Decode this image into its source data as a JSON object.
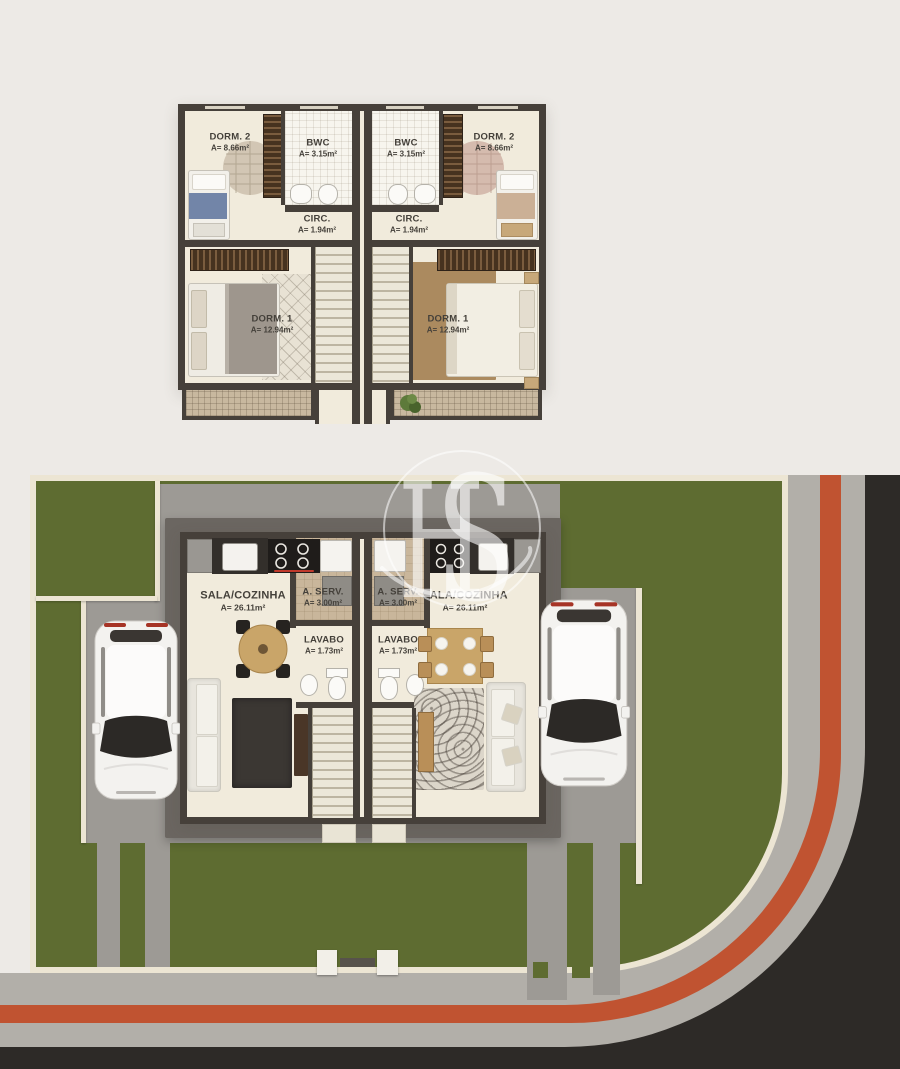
{
  "watermark": {
    "text_h": "H",
    "text_s": "S"
  },
  "upper_floor": {
    "units": [
      {
        "side": "left",
        "dorm2": {
          "name": "DORM. 2",
          "area": "A= 8.66m²"
        },
        "bwc": {
          "name": "BWC",
          "area": "A= 3.15m²"
        },
        "circ": {
          "name": "CIRC.",
          "area": "A= 1.94m²"
        },
        "dorm1": {
          "name": "DORM. 1",
          "area": "A= 12.94m²"
        }
      },
      {
        "side": "right",
        "dorm2": {
          "name": "DORM. 2",
          "area": "A= 8.66m²"
        },
        "bwc": {
          "name": "BWC",
          "area": "A= 3.15m²"
        },
        "circ": {
          "name": "CIRC.",
          "area": "A= 1.94m²"
        },
        "dorm1": {
          "name": "DORM. 1",
          "area": "A= 12.94m²"
        }
      }
    ]
  },
  "ground_floor": {
    "units": [
      {
        "side": "left",
        "sala": {
          "name": "SALA/COZINHA",
          "area": "A= 26.11m²"
        },
        "serv": {
          "name": "A. SERV.",
          "area": "A= 3.00m²"
        },
        "lavabo": {
          "name": "LAVABO",
          "area": "A= 1.73m²"
        }
      },
      {
        "side": "right",
        "sala": {
          "name": "SALA/COZINHA",
          "area": "A= 26.11m²"
        },
        "serv": {
          "name": "A. SERV.",
          "area": "A= 3.00m²"
        },
        "lavabo": {
          "name": "LAVABO",
          "area": "A= 1.73m²"
        }
      }
    ]
  },
  "colors": {
    "background": "#edeae6",
    "lawn": "#5e6c31",
    "road": "#2d2a27",
    "sidewalk": "#b2afa9",
    "curb_red": "#c05331",
    "concrete": "#9d9a95",
    "wall_cream": "#ece5d3",
    "plan_wall": "#46403a",
    "floor": "#f1ebdc",
    "eave": "#6b6661",
    "wood": "#c9a569",
    "text": "#44403a"
  }
}
